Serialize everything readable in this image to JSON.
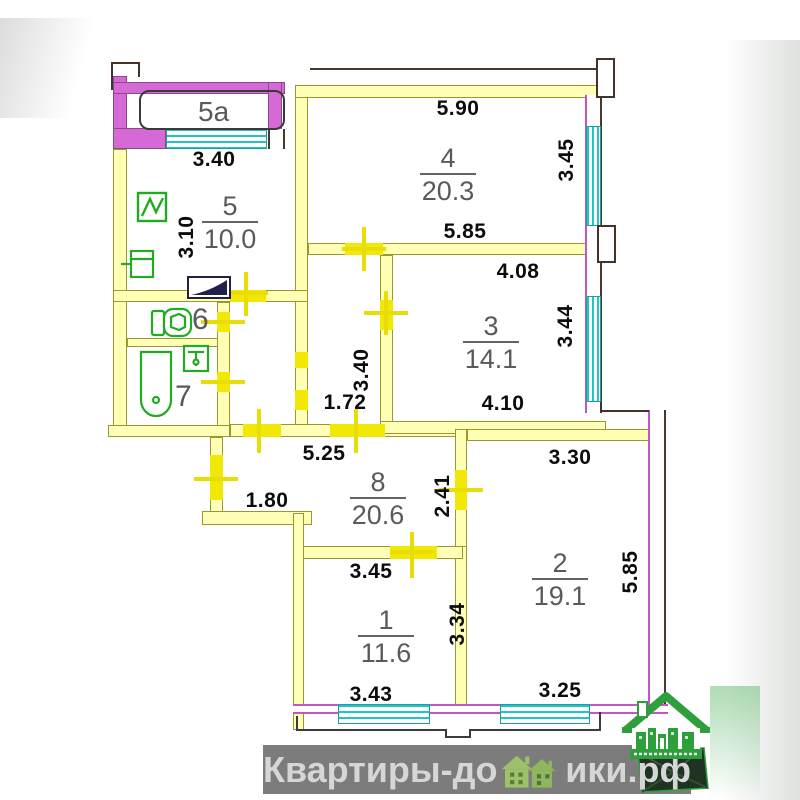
{
  "rooms": {
    "balcony": {
      "number": "5a"
    },
    "kitchen": {
      "number": "5",
      "area": "10.0"
    },
    "r4": {
      "number": "4",
      "area": "20.3"
    },
    "r3": {
      "number": "3",
      "area": "14.1"
    },
    "wc": {
      "number": "6"
    },
    "bath": {
      "number": "7"
    },
    "hall": {
      "number": "8",
      "area": "20.6"
    },
    "r1": {
      "number": "1",
      "area": "11.6"
    },
    "r2": {
      "number": "2",
      "area": "19.1"
    }
  },
  "dims": {
    "balcony_w": "3.40",
    "kitchen_h": "3.10",
    "r4_top": "5.90",
    "r4_right": "3.45",
    "r4_bottom": "5.85",
    "r3_top": "4.08",
    "r3_right": "3.44",
    "r3_bottom": "4.10",
    "corridor_h": "3.40",
    "corridor_w": "1.72",
    "hall_top": "5.25",
    "hall_left": "1.80",
    "hall_right": "2.41",
    "r2_top": "3.30",
    "r2_right": "5.85",
    "r2_bottom": "3.25",
    "r1_top": "3.45",
    "r1_right": "3.34",
    "r1_bottom": "3.43"
  },
  "watermark": {
    "text_before": "Квартиры-до",
    "text_after": "ики.рф",
    "full_text": "Квартиры-домики.рф"
  },
  "colors": {
    "interior_wall": "#ffffb5",
    "interior_wall_outline": "#98982e",
    "exterior_wall": "#d569d5",
    "window": "#26c3c3",
    "door_opening": "#f2e805",
    "fixtures": "#22aa22",
    "dimension_text": "#0c0c0c",
    "room_text": "#5a5a5a",
    "watermark_bg": "#7c7c7c",
    "watermark_text": "#d6d6d6",
    "logo_green": "#2f9e3c"
  }
}
